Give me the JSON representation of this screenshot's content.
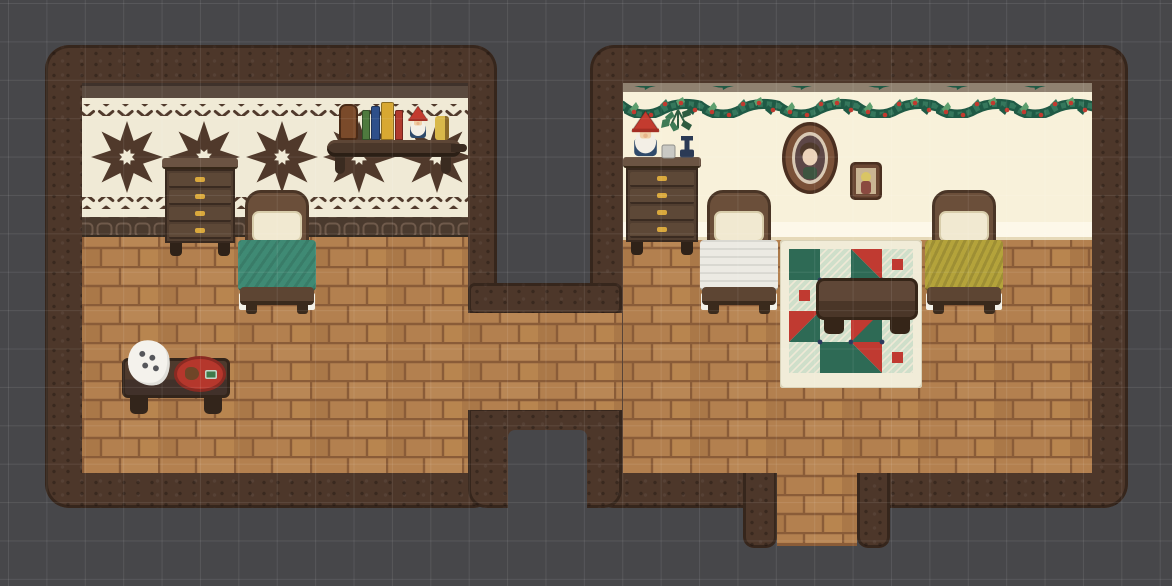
{
  "scene": {
    "type": "pixel-art game interior",
    "description": "Top-down pixel-art view of two cozy wooden-floored bedrooms connected by a corridor, decorated for the winter holidays, shown over a dark gray tile grid",
    "grid": {
      "spacing_px": 38.4,
      "offset_x_px": 8,
      "offset_y_px": 3
    }
  },
  "palette": {
    "bg": "#47474a",
    "grid-line": "#5a5a5e",
    "wall-base": "#4d372a",
    "wall-dark": "#2e2017",
    "floor-base": "#b3804f",
    "floor-light": "#b98755",
    "floor-dark": "#aa7848",
    "floor-mortar": "#8a5c38",
    "cream-left": "#f0ead6",
    "pattern-brown": "#50392b",
    "trim-left": "#5a4a3f",
    "band-base": "#4a3a2e",
    "band-line": "#6f5a4b",
    "cream-right": "#f8f1da",
    "cream-right-light": "#fdf8e9",
    "trim-right": "#8f8170",
    "garland-dark": "#1f5a45",
    "garland-mid": "#35775c",
    "garland-light": "#5d9f6e",
    "berry-red": "#c23a2f",
    "dresser-top": "#6b5443",
    "dresser-body": "#513e30",
    "dresser-face": "#5d4837",
    "dresser-seam": "#38291f",
    "handle-gold": "#d9a83c",
    "bed-frame": "#6b4f3a",
    "bed-frame-dark": "#4a3526",
    "pillow": "#f1e9d1",
    "sheet-white": "#f3f1e8",
    "blanket-teal": "#3f8a74",
    "blanket-white": "#eceae3",
    "blanket-yellow": "#b4a33b",
    "footboard": "#5d4533",
    "shelf-board": "#4a372a",
    "shelf-edge": "#5d4636",
    "jar-brown": "#7a4a2a",
    "book-green": "#4e7a3e",
    "book-blue": "#2e4f8a",
    "book-yellow": "#d8a832",
    "book-red": "#b03a2e",
    "candle-yellow": "#d8b84a",
    "gnome-hat": "#c33b2f",
    "gnome-face": "#f0cfa6",
    "gnome-beard": "#f3efe6",
    "gnome-body": "#2e4a6b",
    "table-top": "#4e3a2d",
    "table-dark": "#33251b",
    "cloth-white": "#f4f2ec",
    "cloth-spot": "#55565a",
    "plate-red": "#b5372c",
    "plate-dark": "#8a2a22",
    "cookie-brown": "#6f4527",
    "mint-green": "#3e7a4a",
    "rug-border": "#f1ecd8",
    "rug-plaid": "#cfdfca",
    "rug-line": "#efe9d6",
    "rug-teal": "#2e6a55",
    "rug-red": "#c03a31",
    "rug-navy": "#2b3a5e",
    "frame-brown": "#7a5138",
    "frame-dark": "#4a2f20",
    "mat-cream": "#d9c9b4",
    "inner-mauve": "#5d4747",
    "face-skin": "#ecd3b9",
    "hair-brown": "#4f3a2c",
    "shirt-green": "#3d5440",
    "frame2-brown": "#6b4733",
    "inner-tan": "#c9b493",
    "hair-blonde": "#d9c565",
    "dress-red": "#8a4a40",
    "plant-green": "#3e7a55",
    "plant-dark": "#2e5c40",
    "vase-navy": "#2b3a55",
    "cup-gray": "#c9c9c4"
  },
  "rooms": {
    "left": {
      "wallpaper": "cream with dark brown snowflake pattern, zigzag borders and dark frieze band",
      "floor": "warm wood planks",
      "objects": [
        "wooden dresser",
        "bed with teal blanket",
        "wall shelf with bottle, books, gnome and candle",
        "low table with pawprint cloth and cookie plate"
      ]
    },
    "right": {
      "wallpaper": "plain cream with evergreen garland and lighter baseboard",
      "floor": "warm wood planks",
      "objects": [
        "wooden dresser with gnome, sprig, candlestick and cup",
        "oval framed portrait",
        "small framed portrait",
        "bed with white quilt",
        "bed with yellow blanket",
        "patchwork holiday rug",
        "dark wooden table"
      ]
    },
    "connections": [
      "west-east corridor between the two rooms",
      "south doorway leading out of the right room"
    ]
  },
  "objects": {
    "dresser_left": {
      "label": "Wooden dresser (4 drawers)"
    },
    "bed_teal": {
      "label": "Bed with teal blanket"
    },
    "wall_shelf": {
      "label": "Wall shelf with bottle, books, gnome and candle"
    },
    "coffee_table": {
      "label": "Low table with pawprint cloth and cookie plate"
    },
    "dresser_right": {
      "label": "Wooden dresser (4 drawers)"
    },
    "gnome_right": {
      "label": "Holiday gnome figurine"
    },
    "hanging_sprig": {
      "label": "Evergreen sprig with candlestick and cup"
    },
    "portrait_large": {
      "label": "Oval framed portrait"
    },
    "portrait_small": {
      "label": "Small framed portrait"
    },
    "bed_white": {
      "label": "Bed with white quilt"
    },
    "bed_yellow": {
      "label": "Bed with yellow blanket"
    },
    "holiday_rug": {
      "label": "Red and green patchwork quilt rug"
    },
    "rug_table": {
      "label": "Dark wooden table"
    },
    "garland": {
      "label": "Evergreen garland with red berries"
    }
  }
}
